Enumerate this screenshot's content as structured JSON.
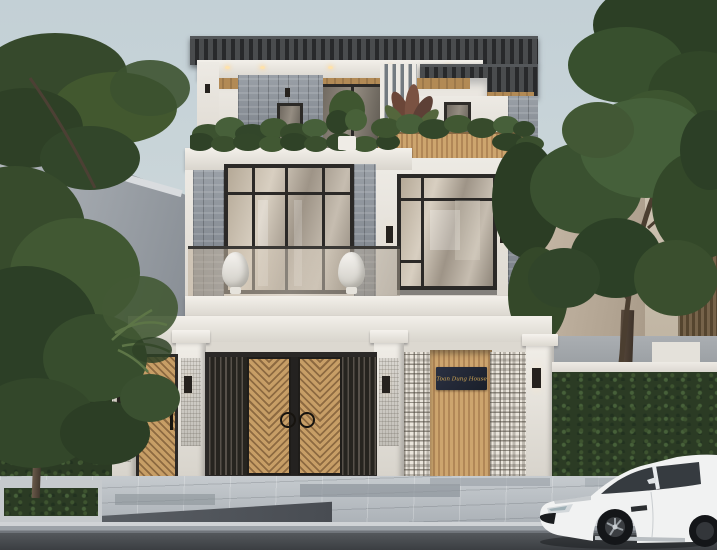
{
  "scene": {
    "description": "3D exterior render of a modern three-storey house: slatted pergola roof, stone and wood cladding, glass balcony, white perimeter fence with wooden slat gates, breeze-block wall with name plaque, street trees, paved sidewalk and a white sports coupe parked at the kerb",
    "sign": {
      "text": "Toan Dung House"
    },
    "palette": {
      "sky": "#c7d3d8",
      "house_white": "#ece9e3",
      "roof_dark": "#2d2f31",
      "wood": "#c1985f",
      "stone": "#8a9096",
      "foliage": "#3f5430",
      "hedge": "#2b3b24",
      "pavement": "#b5bbc1",
      "road": "#3f4246",
      "car": "#f2f2f2",
      "sign_bg": "#232936",
      "sign_text": "#d4a955"
    }
  }
}
